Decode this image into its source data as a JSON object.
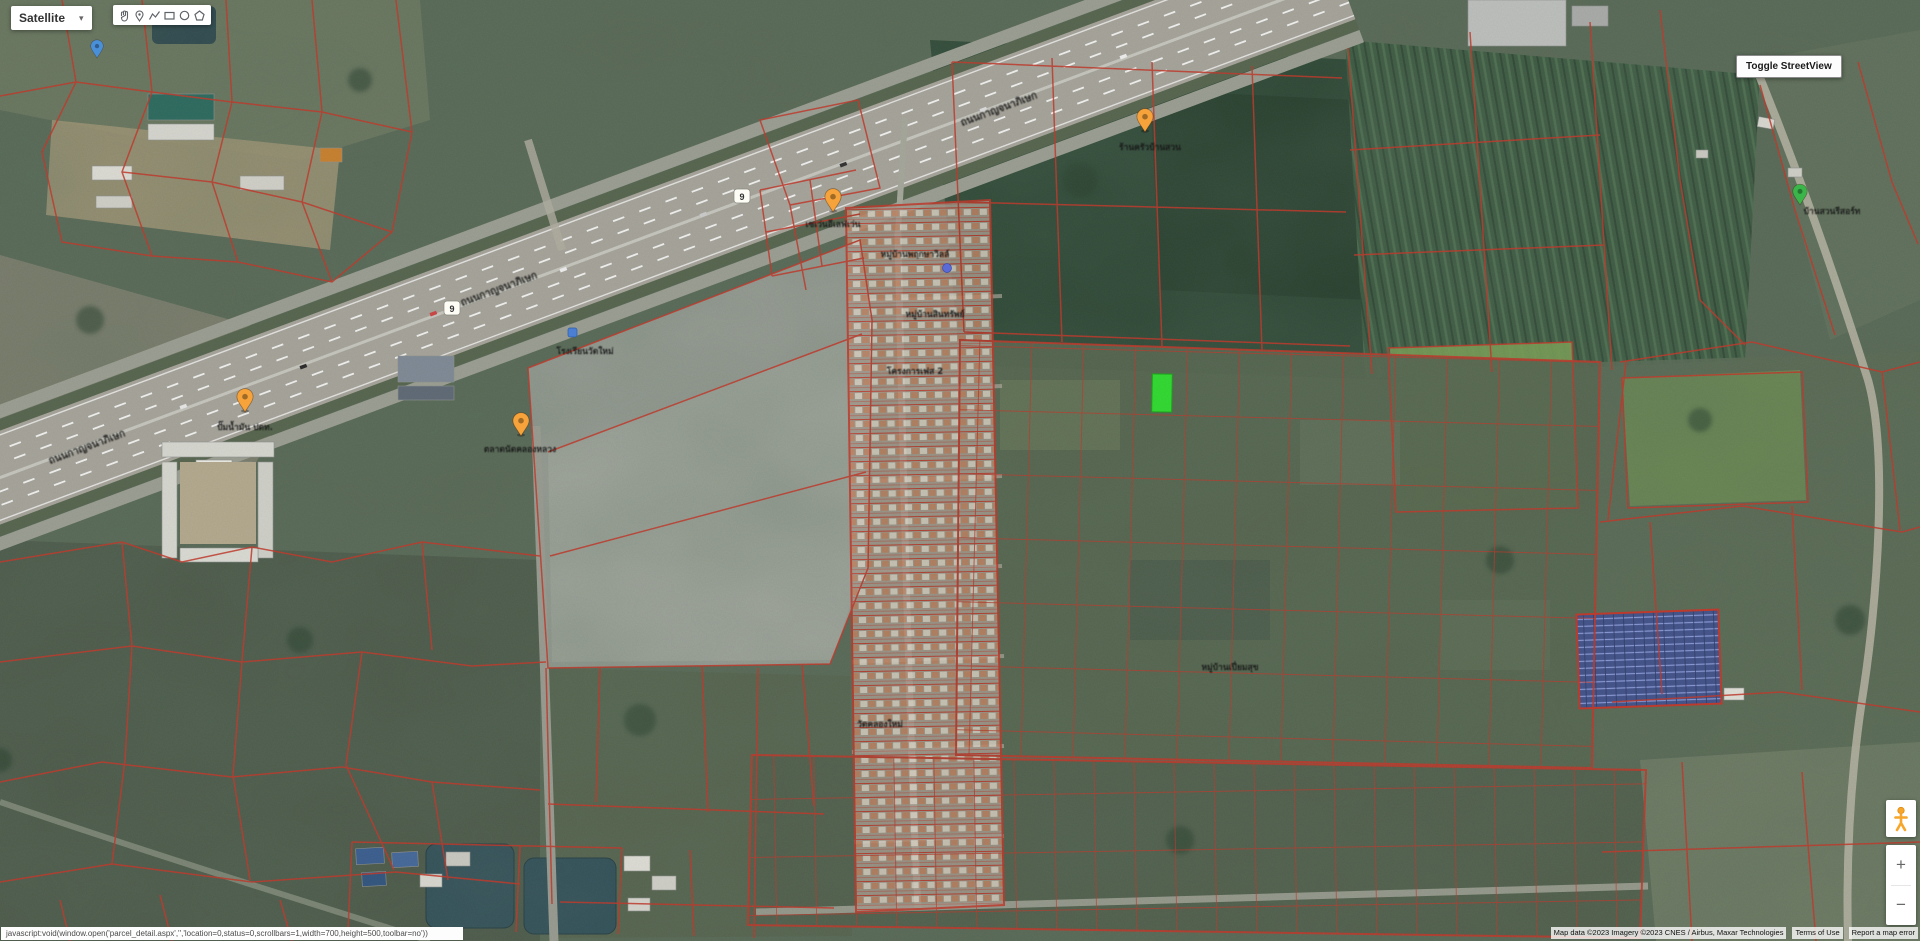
{
  "map_type_control": {
    "label": "Satellite",
    "caret": "▾"
  },
  "drawing_toolbar": {
    "tools": [
      "pan-hand",
      "place-marker",
      "draw-polyline",
      "draw-rectangle",
      "draw-circle",
      "draw-polygon"
    ]
  },
  "streetview_toggle": {
    "label": "Toggle StreetView"
  },
  "zoom_control": {
    "zoom_in": "+",
    "zoom_out": "−"
  },
  "status_bar": {
    "text": "javascript:void(window.open('parcel_detail.aspx','','location=0,status=0,scrollbars=1,width=700,height=500,toolbar=no'))"
  },
  "attribution": {
    "map_data": "Map data ©2023 Imagery ©2023 CNES / Airbus, Maxar Technologies",
    "terms_of_use": "Terms of Use",
    "report_error": "Report a map error"
  },
  "map": {
    "route_shield_number": "9",
    "road_labels": [
      {
        "text": "ถนนกาญจนาภิเษก"
      },
      {
        "text": "ถนนกาญจนาภิเษก"
      },
      {
        "text": "ถนนกาญจนาภิเษก"
      }
    ],
    "poi_labels": [
      {
        "text": "ปั๊มน้ำมัน ปตท."
      },
      {
        "text": "ตลาดนัดคลองหลวง"
      },
      {
        "text": "เซเว่นอีเลฟเว่น"
      },
      {
        "text": "ร้านครัวบ้านสวน"
      },
      {
        "text": "หมู่บ้านพฤกษาวิลล์"
      },
      {
        "text": "หมู่บ้านสินทรัพย์"
      },
      {
        "text": "โครงการเฟส 2"
      },
      {
        "text": "โรงเรียนวัดใหม่"
      },
      {
        "text": "หมู่บ้านเปี่ยมสุข"
      },
      {
        "text": "วัดคลองใหม่"
      },
      {
        "text": "บ้านสวนรีสอร์ท"
      }
    ],
    "colors": {
      "parcel_boundary": "#c0392b",
      "highlighted_parcel": "#30e030",
      "marker_orange": "#f5a33a",
      "marker_blue": "#4a90d9",
      "marker_green": "#3ab54a",
      "water": "#34525b",
      "highway": "#a6a49a"
    }
  }
}
